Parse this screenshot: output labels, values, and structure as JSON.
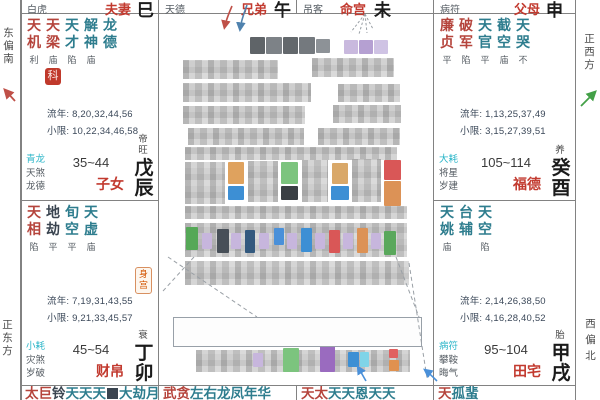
{
  "title": "紫微斗数命盘",
  "colors": {
    "major_star": "#b5443c",
    "minor_star": "#2e7d8e",
    "dark_star": "#3a4450",
    "palace_name": "#c23a2f",
    "ring_first": "#2ab5c8",
    "text_gray": "#555c63",
    "text_num": "#3b4859",
    "ink": "#1b1b1b",
    "grid": "#828282",
    "badge_bg": "#c0392b",
    "body_badge": "#d35400",
    "compass_text": "#4a4a4a",
    "arrow_red": "#bf5048",
    "arrow_blue": "#4f82ae",
    "arrow_green": "#43a047",
    "arrow_blue2": "#4a90d9",
    "leader": "#9aa0a6"
  },
  "compass": {
    "east_south": "东偏南",
    "east": "正东方",
    "west": "正西方",
    "west_north": "西偏北"
  },
  "header_palaces": [
    {
      "ring": "白虎",
      "name": "夫妻",
      "branch": "巳"
    },
    {
      "ring": "天德",
      "name": "兄弟",
      "branch": "午"
    },
    {
      "ring": "吊客",
      "name": "命宫",
      "branch": "未"
    },
    {
      "ring": "病符",
      "name": "父母",
      "branch": "申"
    }
  ],
  "palaces": [
    {
      "key": "zinv",
      "name": "子女",
      "stem_branch": "戊辰",
      "stage": "帝旺",
      "age_range": "35~44",
      "stars": [
        [
          "天机",
          "利",
          "major"
        ],
        [
          "天梁",
          "庙",
          "major"
        ],
        [
          "天才",
          "陷",
          "minor"
        ],
        [
          "解神",
          "庙",
          "minor"
        ],
        [
          "龙德",
          "",
          "minor"
        ]
      ],
      "badge": "科",
      "body_badge": "",
      "liunian": "流年: 8,20,32,44,56",
      "xiaoxian": "小限: 10,22,34,46,58",
      "rings": [
        "青龙",
        "天煞",
        "龙德"
      ]
    },
    {
      "key": "caibo",
      "name": "财帛",
      "stem_branch": "丁卯",
      "stage": "衰",
      "age_range": "45~54",
      "stars": [
        [
          "天相",
          "陷",
          "major"
        ],
        [
          "地劫",
          "平",
          "dark"
        ],
        [
          "旬空",
          "平",
          "minor"
        ],
        [
          "天虚",
          "庙",
          "minor"
        ]
      ],
      "badge": "",
      "body_badge": "身宫",
      "liunian": "流年: 7,19,31,43,55",
      "xiaoxian": "小限: 9,21,33,45,57",
      "rings": [
        "小耗",
        "灾煞",
        "岁破"
      ]
    },
    {
      "key": "fude",
      "name": "福德",
      "stem_branch": "癸酉",
      "stage": "养",
      "age_range": "105~114",
      "stars": [
        [
          "廉贞",
          "平",
          "major"
        ],
        [
          "破军",
          "陷",
          "major"
        ],
        [
          "天官",
          "平",
          "minor"
        ],
        [
          "截空",
          "庙",
          "minor"
        ],
        [
          "天哭",
          "不",
          "minor"
        ]
      ],
      "badge": "",
      "body_badge": "",
      "liunian": "流年: 1,13,25,37,49",
      "xiaoxian": "小限: 3,15,27,39,51",
      "rings": [
        "大耗",
        "将星",
        "岁建"
      ]
    },
    {
      "key": "tianzhai",
      "name": "田宅",
      "stem_branch": "甲戌",
      "stage": "胎",
      "age_range": "95~104",
      "stars": [
        [
          "天姚",
          "庙",
          "minor"
        ],
        [
          "台辅",
          "",
          "minor"
        ],
        [
          "天空",
          "陷",
          "minor"
        ]
      ],
      "badge": "",
      "body_badge": "",
      "liunian": "流年: 2,14,26,38,50",
      "xiaoxian": "小限: 4,16,28,40,52",
      "rings": [
        "病符",
        "攀鞍",
        "晦气"
      ]
    }
  ],
  "bottom_palaces": [
    {
      "chars": [
        [
          "太",
          "major"
        ],
        [
          "巨",
          "major"
        ],
        [
          "铃",
          "dark"
        ],
        [
          "天",
          "minor"
        ],
        [
          "天",
          "minor"
        ],
        [
          "天",
          "minor"
        ],
        [
          "",
          "block"
        ],
        [
          "大",
          "minor"
        ],
        [
          "劫",
          "minor"
        ],
        [
          "月",
          "minor"
        ]
      ]
    },
    {
      "chars": [
        [
          "武",
          "major"
        ],
        [
          "贪",
          "major"
        ],
        [
          "左",
          "minor"
        ],
        [
          "右",
          "minor"
        ],
        [
          "龙",
          "minor"
        ],
        [
          "凤",
          "minor"
        ],
        [
          "年",
          "minor"
        ],
        [
          "华",
          "minor"
        ]
      ]
    },
    {
      "chars": [
        [
          "天",
          "major"
        ],
        [
          "太",
          "major"
        ],
        [
          "天",
          "minor"
        ],
        [
          "天",
          "minor"
        ],
        [
          "恩",
          "minor"
        ],
        [
          "天",
          "minor"
        ],
        [
          "天",
          "minor"
        ]
      ]
    },
    {
      "chars": [
        [
          "天",
          "major"
        ],
        [
          "孤",
          "minor"
        ],
        [
          "蜚",
          "minor"
        ]
      ]
    }
  ],
  "censored": {
    "title_blocks": [
      {
        "x": 250,
        "y": 37,
        "w": 15,
        "h": 17,
        "c": "#5f6468"
      },
      {
        "x": 266,
        "y": 37,
        "w": 16,
        "h": 17,
        "c": "#7d8287"
      },
      {
        "x": 283,
        "y": 37,
        "w": 15,
        "h": 17,
        "c": "#63686c"
      },
      {
        "x": 299,
        "y": 37,
        "w": 16,
        "h": 17,
        "c": "#74797e"
      },
      {
        "x": 316,
        "y": 39,
        "w": 14,
        "h": 14,
        "c": "#8d9297"
      },
      {
        "x": 344,
        "y": 40,
        "w": 14,
        "h": 14,
        "c": "#c9b9de"
      },
      {
        "x": 359,
        "y": 40,
        "w": 14,
        "h": 14,
        "c": "#b5a0d2"
      },
      {
        "x": 374,
        "y": 40,
        "w": 14,
        "h": 14,
        "c": "#cfc3e4"
      }
    ],
    "regions": [
      {
        "x": 183,
        "y": 60,
        "w": 95,
        "h": 19
      },
      {
        "x": 312,
        "y": 58,
        "w": 82,
        "h": 19
      },
      {
        "x": 183,
        "y": 83,
        "w": 128,
        "h": 19
      },
      {
        "x": 338,
        "y": 84,
        "w": 62,
        "h": 18
      },
      {
        "x": 183,
        "y": 106,
        "w": 122,
        "h": 18
      },
      {
        "x": 333,
        "y": 105,
        "w": 68,
        "h": 18
      },
      {
        "x": 188,
        "y": 128,
        "w": 116,
        "h": 17
      },
      {
        "x": 318,
        "y": 128,
        "w": 82,
        "h": 17
      },
      {
        "x": 185,
        "y": 147,
        "w": 212,
        "h": 13
      },
      {
        "x": 185,
        "y": 162,
        "w": 40,
        "h": 42
      },
      {
        "x": 248,
        "y": 161,
        "w": 30,
        "h": 41
      },
      {
        "x": 302,
        "y": 160,
        "w": 26,
        "h": 42
      },
      {
        "x": 352,
        "y": 159,
        "w": 29,
        "h": 43
      },
      {
        "x": 185,
        "y": 206,
        "w": 222,
        "h": 13
      },
      {
        "x": 185,
        "y": 223,
        "w": 222,
        "h": 34
      },
      {
        "x": 185,
        "y": 261,
        "w": 224,
        "h": 24
      },
      {
        "x": 177,
        "y": 321,
        "w": 239,
        "h": 21
      },
      {
        "x": 196,
        "y": 350,
        "w": 214,
        "h": 22
      }
    ],
    "accents": [
      {
        "x": 228,
        "y": 162,
        "w": 16,
        "h": 22,
        "c": "#dfa25e"
      },
      {
        "x": 228,
        "y": 186,
        "w": 16,
        "h": 14,
        "c": "#3d8fd4"
      },
      {
        "x": 281,
        "y": 162,
        "w": 17,
        "h": 22,
        "c": "#7cc47e"
      },
      {
        "x": 281,
        "y": 186,
        "w": 17,
        "h": 14,
        "c": "#3a3f44"
      },
      {
        "x": 332,
        "y": 163,
        "w": 16,
        "h": 21,
        "c": "#d9a869"
      },
      {
        "x": 331,
        "y": 186,
        "w": 18,
        "h": 14,
        "c": "#3d8fd4"
      },
      {
        "x": 384,
        "y": 160,
        "w": 17,
        "h": 20,
        "c": "#d95757"
      },
      {
        "x": 384,
        "y": 181,
        "w": 17,
        "h": 25,
        "c": "#dc9256"
      },
      {
        "x": 186,
        "y": 227,
        "w": 12,
        "h": 23,
        "c": "#55a857"
      },
      {
        "x": 217,
        "y": 229,
        "w": 12,
        "h": 24,
        "c": "#474f58"
      },
      {
        "x": 245,
        "y": 230,
        "w": 10,
        "h": 23,
        "c": "#33597e"
      },
      {
        "x": 274,
        "y": 228,
        "w": 10,
        "h": 17,
        "c": "#4a90d9"
      },
      {
        "x": 301,
        "y": 228,
        "w": 11,
        "h": 24,
        "c": "#3d8fd4"
      },
      {
        "x": 329,
        "y": 230,
        "w": 11,
        "h": 23,
        "c": "#d95757"
      },
      {
        "x": 357,
        "y": 228,
        "w": 11,
        "h": 25,
        "c": "#dc9256"
      },
      {
        "x": 384,
        "y": 231,
        "w": 12,
        "h": 24,
        "c": "#5aa85c"
      },
      {
        "x": 202,
        "y": 233,
        "w": 10,
        "h": 16,
        "c": "#c7b6dd"
      },
      {
        "x": 231,
        "y": 233,
        "w": 10,
        "h": 16,
        "c": "#c7b6dd"
      },
      {
        "x": 259,
        "y": 233,
        "w": 10,
        "h": 16,
        "c": "#c7b6dd"
      },
      {
        "x": 287,
        "y": 233,
        "w": 10,
        "h": 16,
        "c": "#c7b6dd"
      },
      {
        "x": 315,
        "y": 233,
        "w": 10,
        "h": 16,
        "c": "#c7b6dd"
      },
      {
        "x": 343,
        "y": 233,
        "w": 10,
        "h": 16,
        "c": "#c7b6dd"
      },
      {
        "x": 371,
        "y": 233,
        "w": 10,
        "h": 16,
        "c": "#c7b6dd"
      },
      {
        "x": 283,
        "y": 348,
        "w": 16,
        "h": 24,
        "c": "#7cc47e"
      },
      {
        "x": 320,
        "y": 346,
        "w": 15,
        "h": 26,
        "c": "#9a6bbf"
      },
      {
        "x": 348,
        "y": 352,
        "w": 11,
        "h": 15,
        "c": "#3d8fd4"
      },
      {
        "x": 360,
        "y": 352,
        "w": 9,
        "h": 15,
        "c": "#7fd4e8"
      },
      {
        "x": 389,
        "y": 349,
        "w": 9,
        "h": 9,
        "c": "#e06060"
      },
      {
        "x": 389,
        "y": 360,
        "w": 10,
        "h": 11,
        "c": "#e0914f"
      },
      {
        "x": 253,
        "y": 353,
        "w": 10,
        "h": 14,
        "c": "#c7b6dd"
      }
    ]
  }
}
